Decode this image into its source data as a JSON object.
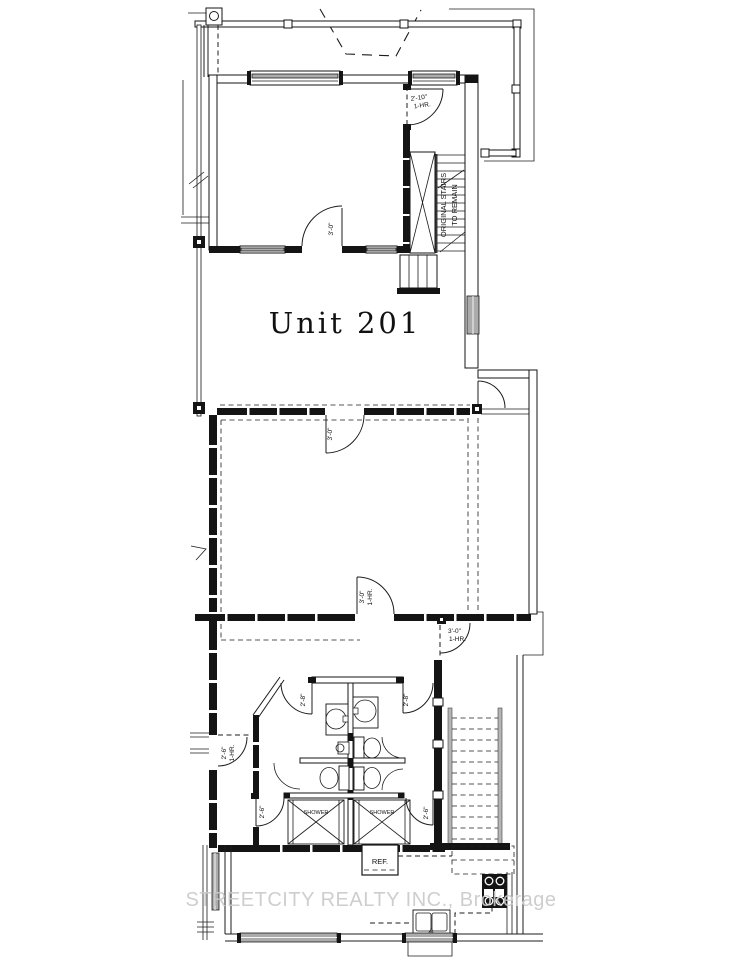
{
  "labels": {
    "unit": "Unit 201",
    "stairs_note_1": "ORIGINAL STAIRS",
    "stairs_note_2": "TO REMAIN",
    "ref": "REF.",
    "shower": "SHOWER",
    "watermark": "STREETCITY REALTY INC., Brokerage"
  },
  "doors": {
    "landing_size": "2'-10\"",
    "landing_rating": "1-HR.",
    "top_room_size": "3'-0\"",
    "middle_top_size": "3'-0\"",
    "middle_bottom_size": "3'-0\"",
    "middle_bottom_rating": "1-HR.",
    "hall_right_size": "3'-0\"",
    "hall_right_rating": "1-HR.",
    "hall_left_size": "2'-6\"",
    "hall_left_rating": "1-HR.",
    "bath_left_size": "2'-8\"",
    "bath_right_size": "2'-8\"",
    "shower_left_size": "2'-6\"",
    "shower_right_size": "2'-6\""
  },
  "colors": {
    "line": "#1c1c1c",
    "wall_fill": "#141414",
    "window_fill": "#ababab",
    "watermark": "#c9c9c9",
    "background": "#ffffff"
  }
}
